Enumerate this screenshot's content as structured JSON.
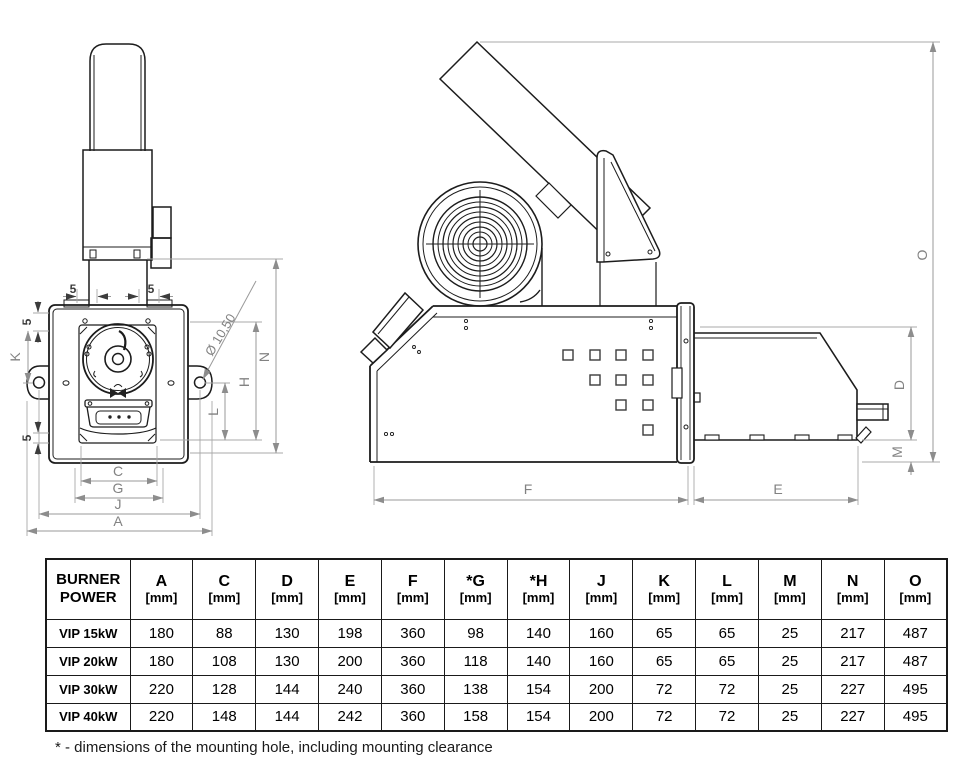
{
  "front_view": {
    "labels": {
      "five_top_left": "5",
      "five_top_right": "5",
      "five_left_upper": "5",
      "five_left_lower": "5",
      "k": "K",
      "n": "N",
      "h": "H",
      "l": "L",
      "c": "C",
      "g": "G",
      "j": "J",
      "a": "A",
      "hole_diameter": "Ø 10,50"
    }
  },
  "side_view": {
    "labels": {
      "f": "F",
      "e": "E",
      "d": "D",
      "m": "M",
      "o": "O"
    }
  },
  "table": {
    "header": {
      "line1": "BURNER",
      "line2": "POWER"
    },
    "columns": [
      {
        "label": "A",
        "unit": "[mm]"
      },
      {
        "label": "C",
        "unit": "[mm]"
      },
      {
        "label": "D",
        "unit": "[mm]"
      },
      {
        "label": "E",
        "unit": "[mm]"
      },
      {
        "label": "F",
        "unit": "[mm]"
      },
      {
        "label": "*G",
        "unit": "[mm]"
      },
      {
        "label": "*H",
        "unit": "[mm]"
      },
      {
        "label": "J",
        "unit": "[mm]"
      },
      {
        "label": "K",
        "unit": "[mm]"
      },
      {
        "label": "L",
        "unit": "[mm]"
      },
      {
        "label": "M",
        "unit": "[mm]"
      },
      {
        "label": "N",
        "unit": "[mm]"
      },
      {
        "label": "O",
        "unit": "[mm]"
      }
    ],
    "rows": [
      {
        "power": "VIP 15kW",
        "values": [
          "180",
          "88",
          "130",
          "198",
          "360",
          "98",
          "140",
          "160",
          "65",
          "65",
          "25",
          "217",
          "487"
        ]
      },
      {
        "power": "VIP 20kW",
        "values": [
          "180",
          "108",
          "130",
          "200",
          "360",
          "118",
          "140",
          "160",
          "65",
          "65",
          "25",
          "217",
          "487"
        ]
      },
      {
        "power": "VIP 30kW",
        "values": [
          "220",
          "128",
          "144",
          "240",
          "360",
          "138",
          "154",
          "200",
          "72",
          "72",
          "25",
          "227",
          "495"
        ]
      },
      {
        "power": "VIP 40kW",
        "values": [
          "220",
          "148",
          "144",
          "242",
          "360",
          "158",
          "154",
          "200",
          "72",
          "72",
          "25",
          "227",
          "495"
        ]
      }
    ]
  },
  "footnote": "* - dimensions of the mounting hole, including mounting clearance",
  "colors": {
    "drawing_line": "#1c1c1c",
    "dimension_line": "#9a9a9a",
    "dimension_text": "#828282",
    "table_border": "#1a1a1a",
    "background": "#ffffff"
  }
}
